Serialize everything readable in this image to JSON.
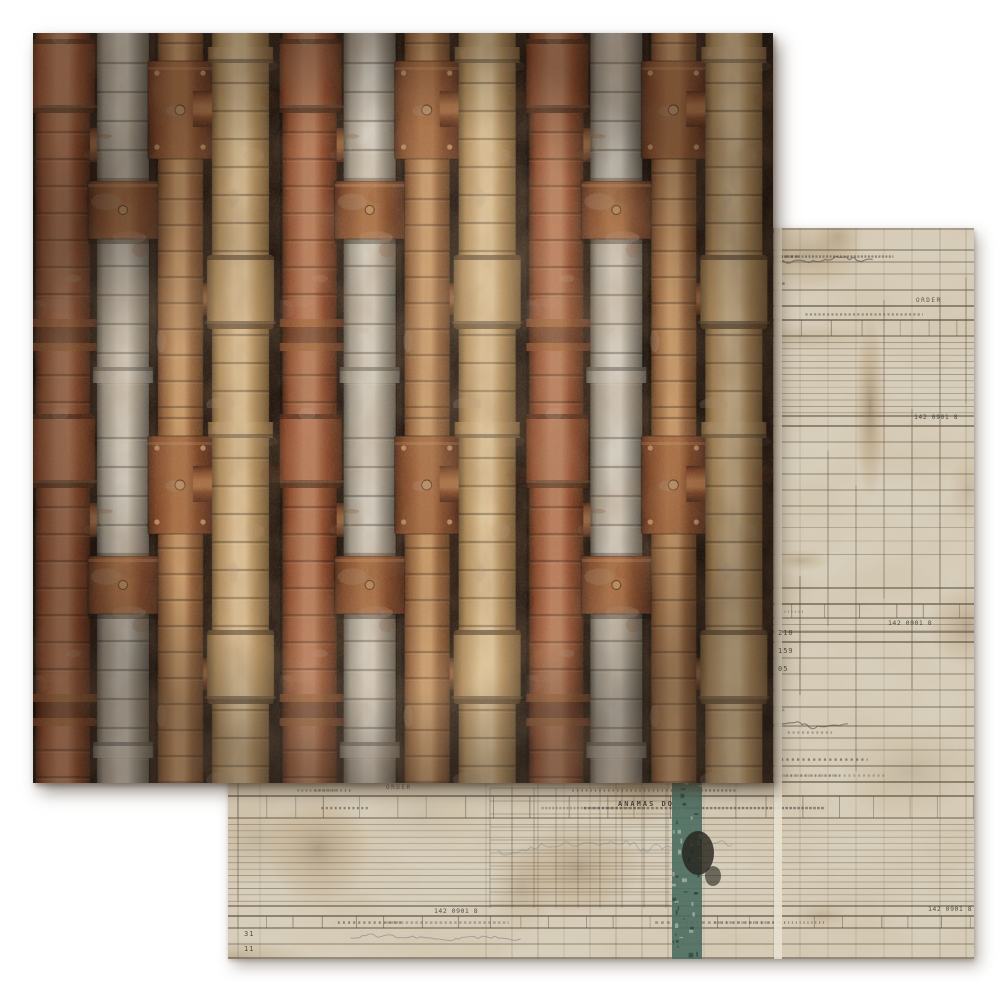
{
  "photo": {
    "background_color": "#ffffff",
    "subject": "two overlapping sheets of double-sided patterned scrapbook paper"
  },
  "front_sheet": {
    "pattern": "rusted industrial pipes",
    "colors": {
      "gap_dark": "#221710",
      "gap_darker": "#120c06",
      "rust_pipe": {
        "dark": "#4a2413",
        "base": "#8d4a2c",
        "light": "#b97e5d"
      },
      "steel_pipe": {
        "dark": "#56524a",
        "base": "#9e988c",
        "light": "#d2ccc0"
      },
      "copper_pipe": {
        "dark": "#5c3a20",
        "base": "#92603a",
        "light": "#c79a6a"
      },
      "tan_pipe": {
        "dark": "#6e5433",
        "base": "#b08d5c",
        "light": "#dcc298"
      },
      "coupling": {
        "dark": "#50291a",
        "base": "#7c4526",
        "light": "#a96f45"
      },
      "bolt": "#b98a5f"
    }
  },
  "back_sheet": {
    "pattern": "vintage ledger record forms",
    "colors": {
      "paper": "#d8cfbc",
      "paper_light": "#e9e2d2",
      "rule": "#55493a",
      "rule_soft": "#7a6d59",
      "ink": "#4c4740",
      "ink_blue": "#5d7189",
      "stain": "#a37f4e",
      "stain_dark": "#6b4f2e",
      "teal": "#4a6d60",
      "blot": "#23211a"
    },
    "labels": {
      "station_name": "ANAMAS  DO",
      "stamp_number": "142 0901 8",
      "order_word": "ORDER",
      "row_numbers_bottom": [
        "31",
        "11"
      ],
      "row_numbers_right": [
        "210",
        "159",
        "05"
      ]
    }
  }
}
